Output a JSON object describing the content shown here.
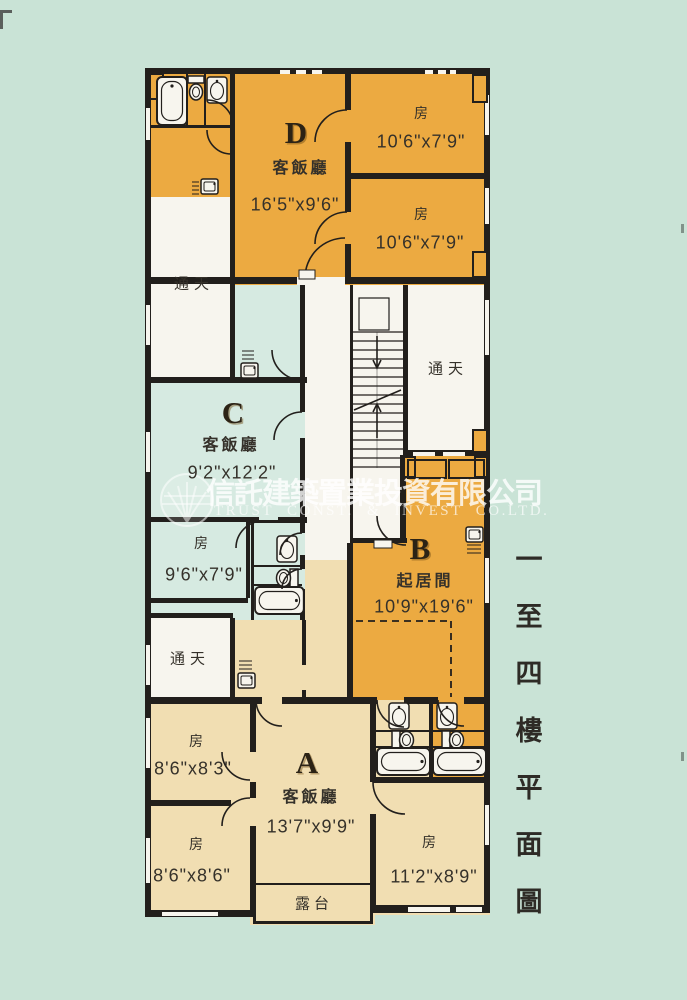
{
  "title": {
    "vertical_text": "一至四樓平面圖"
  },
  "watermark": {
    "company_cn": "信託建築置業投資有限公司",
    "company_en": "TRUST CONST. & INVEST CO.LTD."
  },
  "plan": {
    "lightwell_label": "通天",
    "balcony_label": "露台",
    "units": {
      "D": {
        "letter": "D",
        "living_label": "客飯廳",
        "living_dims": "16'5\"x9'6\"",
        "rooms": [
          {
            "label": "房",
            "dims": "10'6\"x7'9\""
          },
          {
            "label": "房",
            "dims": "10'6\"x7'9\""
          }
        ]
      },
      "C": {
        "letter": "C",
        "living_label": "客飯廳",
        "living_dims": "9'2\"x12'2\"",
        "rooms": [
          {
            "label": "房",
            "dims": "9'6\"x7'9\""
          }
        ]
      },
      "B": {
        "letter": "B",
        "living_label": "起居間",
        "living_dims": "10'9\"x19'6\""
      },
      "A": {
        "letter": "A",
        "living_label": "客飯廳",
        "living_dims": "13'7\"x9'9\"",
        "rooms": [
          {
            "label": "房",
            "dims": "8'6\"x8'3\""
          },
          {
            "label": "房",
            "dims": "8'6\"x8'6\""
          },
          {
            "label": "房",
            "dims": "11'2\"x8'9\""
          }
        ]
      }
    }
  },
  "colors": {
    "background": "#c9e3d6",
    "unit_orange": "#ecaa41",
    "unit_cream": "#f1deb2",
    "unit_mint": "#d6eae1",
    "floor_white": "#f7f5ee",
    "wall": "#221f1c",
    "text_dark": "#35312a"
  }
}
